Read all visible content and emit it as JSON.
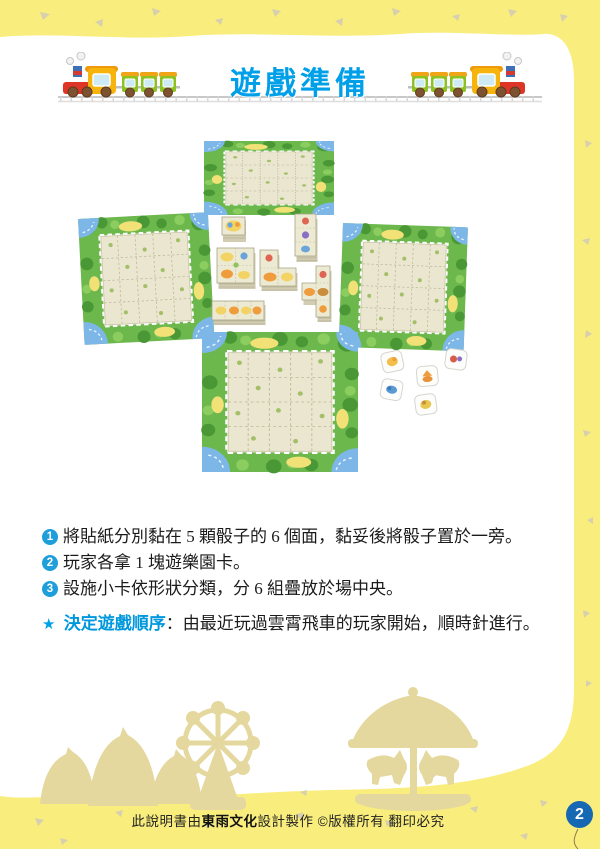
{
  "header": {
    "title": "遊戲準備"
  },
  "instructions": [
    {
      "num": "1",
      "text": "將貼紙分別黏在 5 顆骰子的 6 個面，黏妥後將骰子置於一旁。"
    },
    {
      "num": "2",
      "text": "玩家各拿 1 塊遊樂園卡。"
    },
    {
      "num": "3",
      "text": "設施小卡依形狀分類，分 6 組疊放於場中央。"
    }
  ],
  "note": {
    "star": "★",
    "label": "決定遊戲順序",
    "colon": "：",
    "text": "由最近玩過雲霄飛車的玩家開始，順時針進行。"
  },
  "footer": {
    "prefix": "此說明書由",
    "publisher": "東雨文化",
    "suffix": "設計製作 ©版權所有 翻印必究"
  },
  "page_number": "2",
  "illustration": {
    "items": [
      "park-board-top",
      "park-board-left",
      "park-board-right",
      "park-board-bottom",
      "card-stack-single",
      "card-stack-i3",
      "card-stack-2x2",
      "card-stack-l",
      "card-stack-t",
      "card-stack-i4",
      "dice-group"
    ],
    "dice_count": 5,
    "card_stack_count": 6,
    "board_count": 4
  },
  "decor_icons": [
    "train-left-icon",
    "train-right-icon",
    "railway-track-icon",
    "tents-icon",
    "ferris-wheel-icon",
    "carousel-icon",
    "balloon-icon"
  ],
  "colors": {
    "accent_blue": "#00a0e9",
    "badge_blue": "#1e9fdb",
    "balloon_blue": "#1668b3",
    "frame_yellow": "#f9ee7d",
    "silhouette_tan": "#e4d89e"
  }
}
